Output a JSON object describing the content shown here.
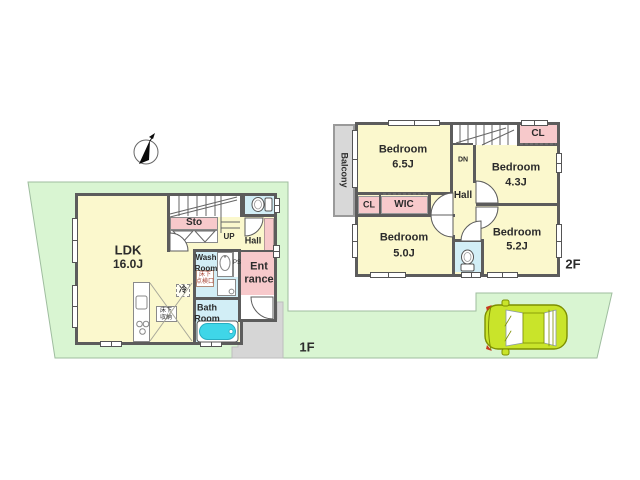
{
  "colors": {
    "land_green": "#d9f5d2",
    "approach_gray": "#d6d6d6",
    "room_yellow": "#fbf8cd",
    "room_pink": "#f7c9cb",
    "room_blue": "#d2eef6",
    "wall_gray": "#5c5c5c",
    "balcony_gray": "#d8d8d8",
    "tub_teal": "#3fd6e8",
    "car_body": "#c9e42a"
  },
  "f1": {
    "floor_label": "1F",
    "ldk": "LDK",
    "ldk_size": "16.0J",
    "sto": "Sto",
    "up": "UP",
    "hall": "Hall",
    "wash_line1": "Wash",
    "wash_line2": "Room",
    "bath_line1": "Bath",
    "bath_line2": "Room",
    "ent_line1": "Ent",
    "ent_line2": "rance",
    "fridge": "冷",
    "ps": "PS",
    "hatch_line1": "床下",
    "hatch_line2": "点検口",
    "storage_line1": "床下",
    "storage_line2": "収納"
  },
  "f2": {
    "floor_label": "2F",
    "balcony": "Balcony",
    "bedroom65": "Bedroom",
    "bedroom65_size": "6.5J",
    "bedroom43": "Bedroom",
    "bedroom43_size": "4.3J",
    "bedroom50": "Bedroom",
    "bedroom50_size": "5.0J",
    "bedroom52": "Bedroom",
    "bedroom52_size": "5.2J",
    "cl_top": "CL",
    "cl_left": "CL",
    "wic": "WIC",
    "hall": "Hall",
    "dn": "DN"
  }
}
